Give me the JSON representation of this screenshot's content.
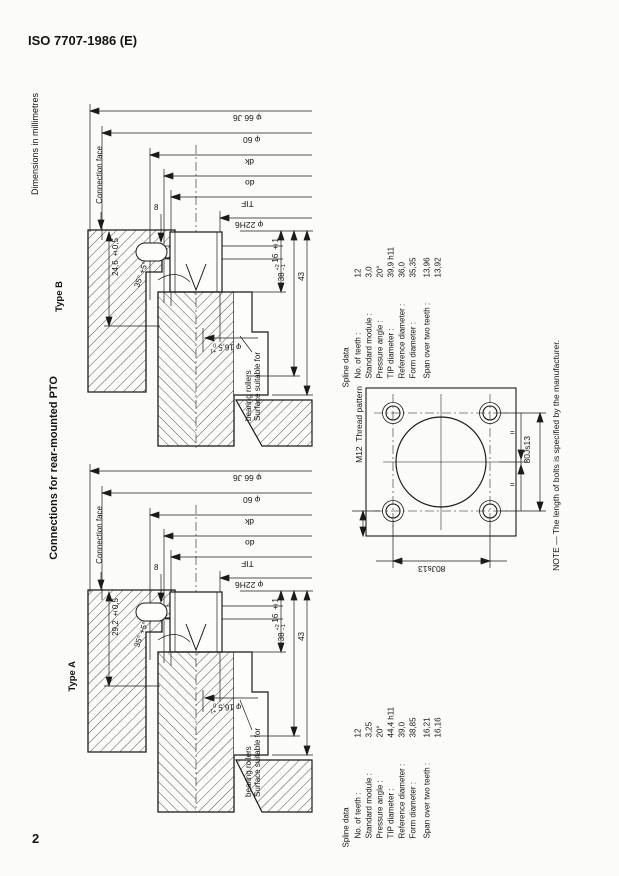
{
  "page": {
    "header": "ISO 7707-1986 (E)",
    "dims_note": "Dimensions in millimetres",
    "title": "Connections for rear-mounted PTO",
    "note": "NOTE — The length of bolts is specified by the manufacturer.",
    "page_number": "2"
  },
  "drawing_b": {
    "label": "Type B",
    "connection_face": "Connection face",
    "surface_note": "Surface suitable for\nbearing rollers",
    "dims": {
      "bearing_bore": "φ 66 J6",
      "boss": "φ 60",
      "dk": "dk",
      "do": "do",
      "tif": "TIF",
      "pilot": "φ 22H6",
      "spline_length": "24,6 ±0,5",
      "groove_width": "8",
      "chamfer_angle": "35° +5°",
      "hole": "φ 16,5",
      "hole_tol_top": "+1",
      "hole_tol_bottom": "0",
      "depth1": "16 ±1",
      "depth2": "38",
      "depth2_tol_top": "+2",
      "depth2_tol_bottom": "−1",
      "depth3": "43"
    },
    "spline": {
      "title": "Spline data",
      "rows": [
        {
          "label": "No. of teeth :",
          "value": "12"
        },
        {
          "label": "Standard module :",
          "value": "3,0"
        },
        {
          "label": "Pressure angle :",
          "value": "20°"
        },
        {
          "label": "TIP diameter :",
          "value": "39,9 h11"
        },
        {
          "label": "Reference diameter :",
          "value": "36,0"
        },
        {
          "label": "Form diameter :",
          "value": "35,35"
        },
        {
          "label": "Span over two teeth :",
          "value": "13,96\n13,92"
        }
      ]
    }
  },
  "drawing_a": {
    "label": "Type A",
    "connection_face": "Connection face",
    "surface_note": "Surface suitable for\nbearing rollers",
    "dims": {
      "bearing_bore": "φ 66 J6",
      "boss": "φ 60",
      "dk": "dk",
      "do": "do",
      "tif": "TIF",
      "pilot": "φ 22H6",
      "spline_length": "29,2 ±0,5",
      "groove_width": "8",
      "chamfer_angle": "35° +5°",
      "hole": "φ 16,5",
      "hole_tol_top": "+1",
      "hole_tol_bottom": "0",
      "depth1": "16 ±1",
      "depth2": "38",
      "depth2_tol_top": "+2",
      "depth2_tol_bottom": "−1",
      "depth3": "43"
    },
    "spline": {
      "title": "Spline data",
      "rows": [
        {
          "label": "No. of teeth :",
          "value": "12"
        },
        {
          "label": "Standard module :",
          "value": "3,25"
        },
        {
          "label": "Pressure angle :",
          "value": "20°"
        },
        {
          "label": "TIP diameter :",
          "value": "44,4 h11"
        },
        {
          "label": "Reference diameter :",
          "value": "39,0"
        },
        {
          "label": "Form diameter :",
          "value": "38,85"
        },
        {
          "label": "Span over two teeth :",
          "value": "16,21\n16,16"
        }
      ]
    }
  },
  "thread_pattern": {
    "label": "M12  Thread pattern",
    "dim_bottom": "80Js13",
    "dim_right": "80Js13",
    "eq_mark": "="
  }
}
